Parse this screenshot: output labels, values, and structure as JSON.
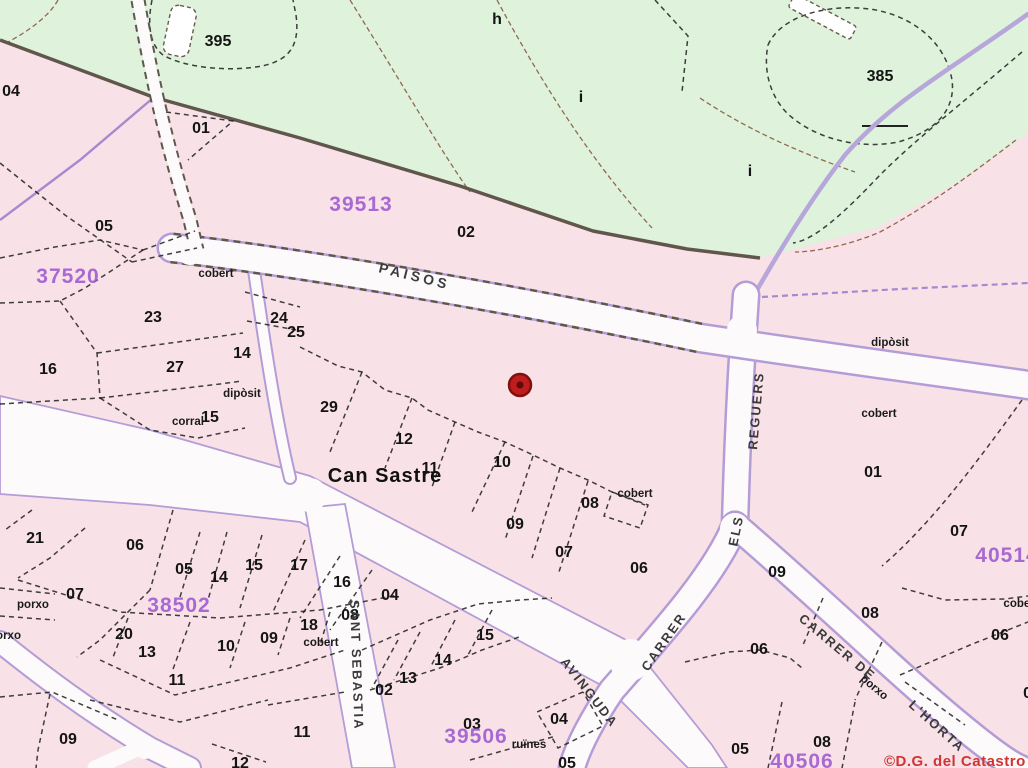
{
  "map": {
    "colors": {
      "urban_pink": "#f8e2e7",
      "rural_green": "#def2dc",
      "road_white": "#fdfafb",
      "road_casing_purple": "#b49cd6",
      "block_number_purple": "#a25fd2",
      "parcel_line_black": "#1f1f1f",
      "boundary_dark": "#60564b",
      "marker_red": "#bf1d1d",
      "copyright_red": "#d03434"
    },
    "marker": {
      "x": 520,
      "y": 385
    },
    "copyright": {
      "text": "©D.G. del Catastro",
      "x": 884,
      "y": 766
    },
    "place_labels": [
      {
        "text": "Can Sastre",
        "x": 385,
        "y": 482
      }
    ],
    "rural_parcel_labels": [
      {
        "text": "395",
        "x": 218,
        "y": 46
      },
      {
        "text": "h",
        "x": 497,
        "y": 24
      },
      {
        "text": "i",
        "x": 581,
        "y": 102
      },
      {
        "text": "385",
        "x": 880,
        "y": 81
      },
      {
        "text": "i",
        "x": 750,
        "y": 176
      }
    ],
    "parcel_numbers": [
      {
        "text": "04",
        "x": 11,
        "y": 96
      },
      {
        "text": "01",
        "x": 201,
        "y": 133
      },
      {
        "text": "05",
        "x": 104,
        "y": 231
      },
      {
        "text": "02",
        "x": 466,
        "y": 237
      },
      {
        "text": "23",
        "x": 153,
        "y": 322
      },
      {
        "text": "24",
        "x": 279,
        "y": 323
      },
      {
        "text": "25",
        "x": 296,
        "y": 337
      },
      {
        "text": "14",
        "x": 242,
        "y": 358
      },
      {
        "text": "16",
        "x": 48,
        "y": 374
      },
      {
        "text": "27",
        "x": 175,
        "y": 372
      },
      {
        "text": "15",
        "x": 210,
        "y": 422
      },
      {
        "text": "29",
        "x": 329,
        "y": 412
      },
      {
        "text": "12",
        "x": 404,
        "y": 444
      },
      {
        "text": "11",
        "x": 430,
        "y": 473
      },
      {
        "text": "10",
        "x": 502,
        "y": 467
      },
      {
        "text": "09",
        "x": 515,
        "y": 529
      },
      {
        "text": "08",
        "x": 590,
        "y": 508
      },
      {
        "text": "07",
        "x": 564,
        "y": 557
      },
      {
        "text": "06",
        "x": 639,
        "y": 573
      },
      {
        "text": "01",
        "x": 873,
        "y": 477
      },
      {
        "text": "07",
        "x": 959,
        "y": 536
      },
      {
        "text": "06",
        "x": 1000,
        "y": 640
      },
      {
        "text": "08",
        "x": 870,
        "y": 618
      },
      {
        "text": "09",
        "x": 777,
        "y": 577
      },
      {
        "text": "08",
        "x": 1032,
        "y": 698
      },
      {
        "text": "21",
        "x": 35,
        "y": 543
      },
      {
        "text": "06",
        "x": 135,
        "y": 550
      },
      {
        "text": "05",
        "x": 184,
        "y": 574
      },
      {
        "text": "14",
        "x": 219,
        "y": 582
      },
      {
        "text": "15",
        "x": 254,
        "y": 570
      },
      {
        "text": "17",
        "x": 299,
        "y": 570
      },
      {
        "text": "16",
        "x": 342,
        "y": 587
      },
      {
        "text": "04",
        "x": 390,
        "y": 600
      },
      {
        "text": "07",
        "x": 75,
        "y": 599
      },
      {
        "text": "20",
        "x": 124,
        "y": 639
      },
      {
        "text": "13",
        "x": 147,
        "y": 657
      },
      {
        "text": "10",
        "x": 226,
        "y": 651
      },
      {
        "text": "09",
        "x": 269,
        "y": 643
      },
      {
        "text": "18",
        "x": 309,
        "y": 630
      },
      {
        "text": "08",
        "x": 350,
        "y": 620
      },
      {
        "text": "11",
        "x": 177,
        "y": 685
      },
      {
        "text": "09",
        "x": 68,
        "y": 744
      },
      {
        "text": "02",
        "x": 384,
        "y": 695
      },
      {
        "text": "13",
        "x": 408,
        "y": 683
      },
      {
        "text": "14",
        "x": 443,
        "y": 665
      },
      {
        "text": "15",
        "x": 485,
        "y": 640
      },
      {
        "text": "11",
        "x": 302,
        "y": 737
      },
      {
        "text": "12",
        "x": 240,
        "y": 768
      },
      {
        "text": "03",
        "x": 472,
        "y": 729
      },
      {
        "text": "04",
        "x": 559,
        "y": 724
      },
      {
        "text": "05",
        "x": 567,
        "y": 768
      },
      {
        "text": "06",
        "x": 759,
        "y": 654
      },
      {
        "text": "05",
        "x": 740,
        "y": 754
      },
      {
        "text": "08",
        "x": 822,
        "y": 747
      }
    ],
    "sub_labels": [
      {
        "text": "cobert",
        "x": 216,
        "y": 277
      },
      {
        "text": "dipòsit",
        "x": 242,
        "y": 397
      },
      {
        "text": "corral",
        "x": 188,
        "y": 425
      },
      {
        "text": "cobert",
        "x": 635,
        "y": 497
      },
      {
        "text": "dipòsit",
        "x": 890,
        "y": 346
      },
      {
        "text": "cobert",
        "x": 879,
        "y": 417
      },
      {
        "text": "cobert",
        "x": 1021,
        "y": 607
      },
      {
        "text": "porxo",
        "x": 33,
        "y": 608
      },
      {
        "text": "porxo",
        "x": 5,
        "y": 639
      },
      {
        "text": "cobert",
        "x": 321,
        "y": 646
      },
      {
        "text": "ruïnes",
        "x": 529,
        "y": 748
      },
      {
        "text": "porxo",
        "x": 872,
        "y": 690,
        "rot": 40
      }
    ],
    "block_numbers": [
      {
        "text": "39513",
        "x": 361,
        "y": 211
      },
      {
        "text": "37520",
        "x": 68,
        "y": 283
      },
      {
        "text": "38502",
        "x": 179,
        "y": 612
      },
      {
        "text": "39506",
        "x": 476,
        "y": 743
      },
      {
        "text": "40514",
        "x": 1007,
        "y": 562
      },
      {
        "text": "40506",
        "x": 802,
        "y": 768
      }
    ],
    "street_names": [
      {
        "text": "PAISOS",
        "x": 378,
        "y": 272,
        "rot": 14,
        "cls": "street-wide"
      },
      {
        "text": "REGUERS",
        "x": 757,
        "y": 450,
        "rot": -85,
        "cls": "street"
      },
      {
        "text": "ELS",
        "x": 737,
        "y": 547,
        "rot": -78,
        "cls": "street"
      },
      {
        "text": "CARRER",
        "x": 648,
        "y": 672,
        "rot": -55,
        "cls": "street"
      },
      {
        "text": "AVINGUDA",
        "x": 560,
        "y": 662,
        "rot": 52,
        "cls": "street"
      },
      {
        "text": "CARRER DE",
        "x": 798,
        "y": 620,
        "rot": 40,
        "cls": "street"
      },
      {
        "text": "L'HORTA",
        "x": 908,
        "y": 706,
        "rot": 42,
        "cls": "street"
      },
      {
        "text": "SANT SEBASTIA",
        "x": 350,
        "y": 600,
        "rot": 88,
        "cls": "street"
      }
    ]
  }
}
